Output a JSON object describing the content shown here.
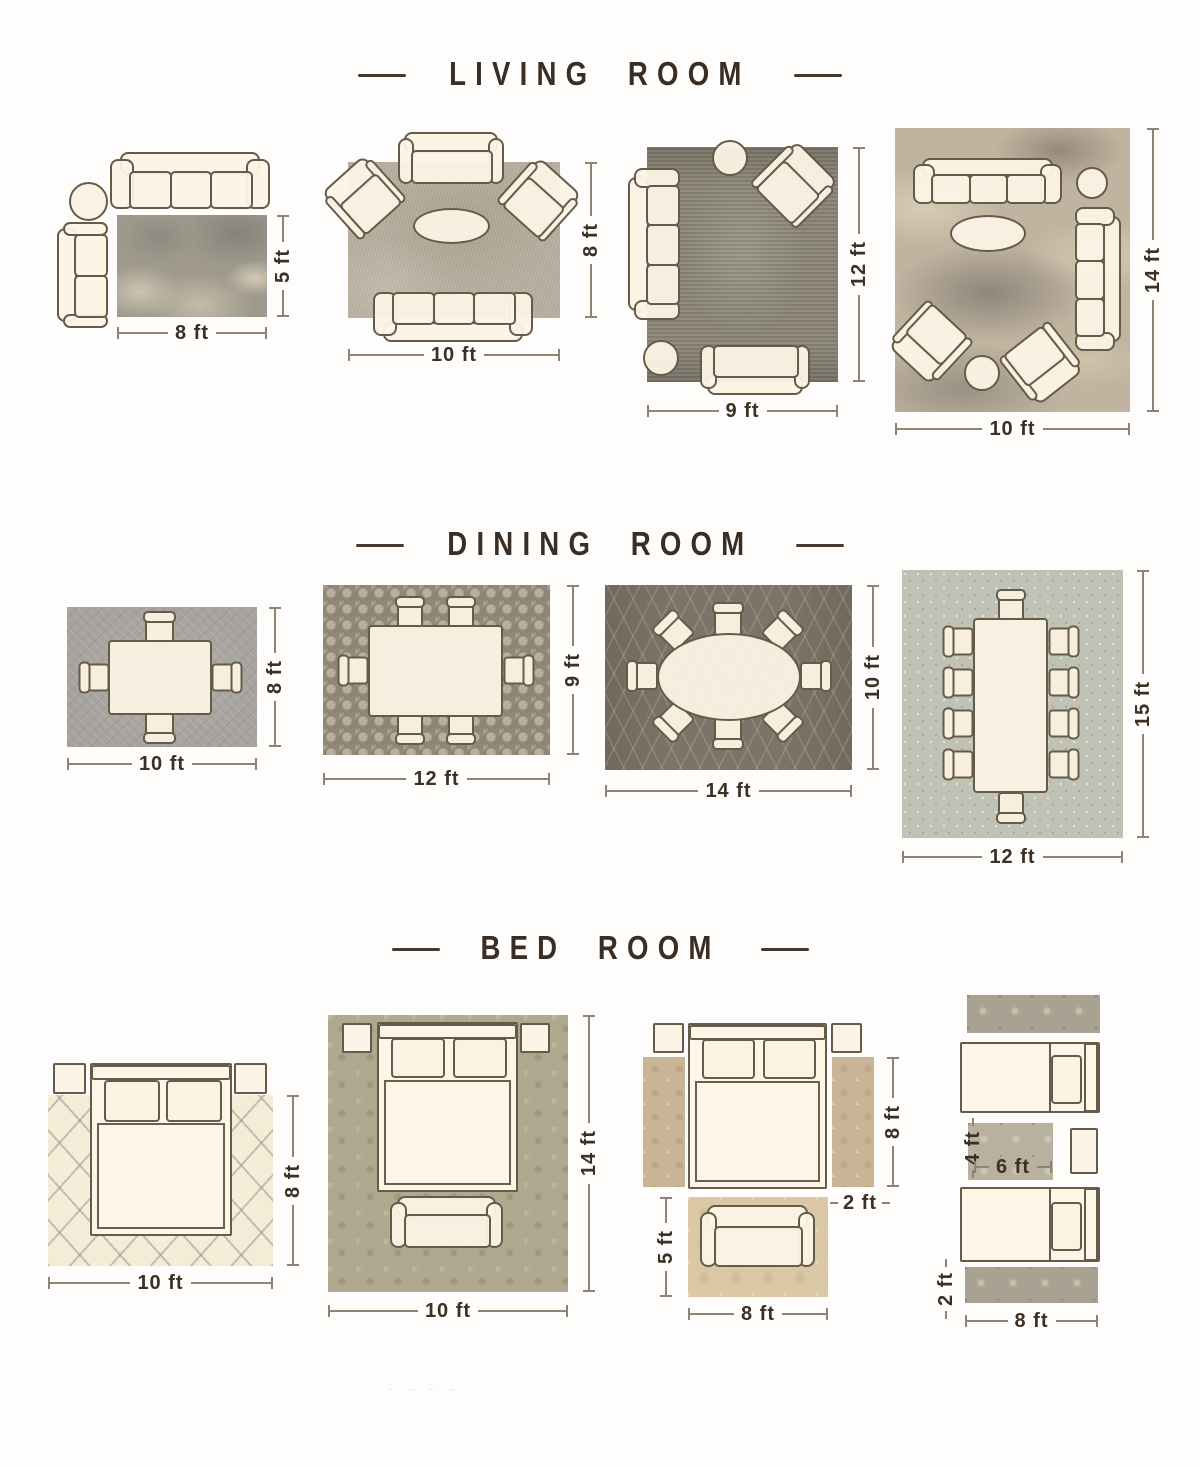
{
  "sections": {
    "living": {
      "title": "LIVING ROOM",
      "layouts": {
        "l1": {
          "width": "8 ft",
          "height": "5 ft"
        },
        "l2": {
          "width": "10 ft",
          "height": "8 ft"
        },
        "l3": {
          "width": "9 ft",
          "height": "12 ft"
        },
        "l4": {
          "width": "10 ft",
          "height": "14 ft"
        }
      }
    },
    "dining": {
      "title": "DINING ROOM",
      "layouts": {
        "d1": {
          "width": "10 ft",
          "height": "8 ft"
        },
        "d2": {
          "width": "12 ft",
          "height": "9 ft"
        },
        "d3": {
          "width": "14 ft",
          "height": "10 ft"
        },
        "d4": {
          "width": "12 ft",
          "height": "15 ft"
        }
      }
    },
    "bedroom": {
      "title": "BED ROOM",
      "layouts": {
        "b1": {
          "width": "10 ft",
          "height": "8 ft"
        },
        "b2": {
          "width": "10 ft",
          "height": "14 ft"
        },
        "b3": {
          "height": "8 ft",
          "runner_width": "2 ft",
          "foot_rug_height": "5 ft",
          "foot_rug_width": "8 ft"
        },
        "b4": {
          "accent_rug_height": "4 ft",
          "accent_rug_width": "6 ft",
          "runner_height": "2 ft",
          "width": "8 ft"
        }
      }
    }
  },
  "watermark": "– – – –"
}
